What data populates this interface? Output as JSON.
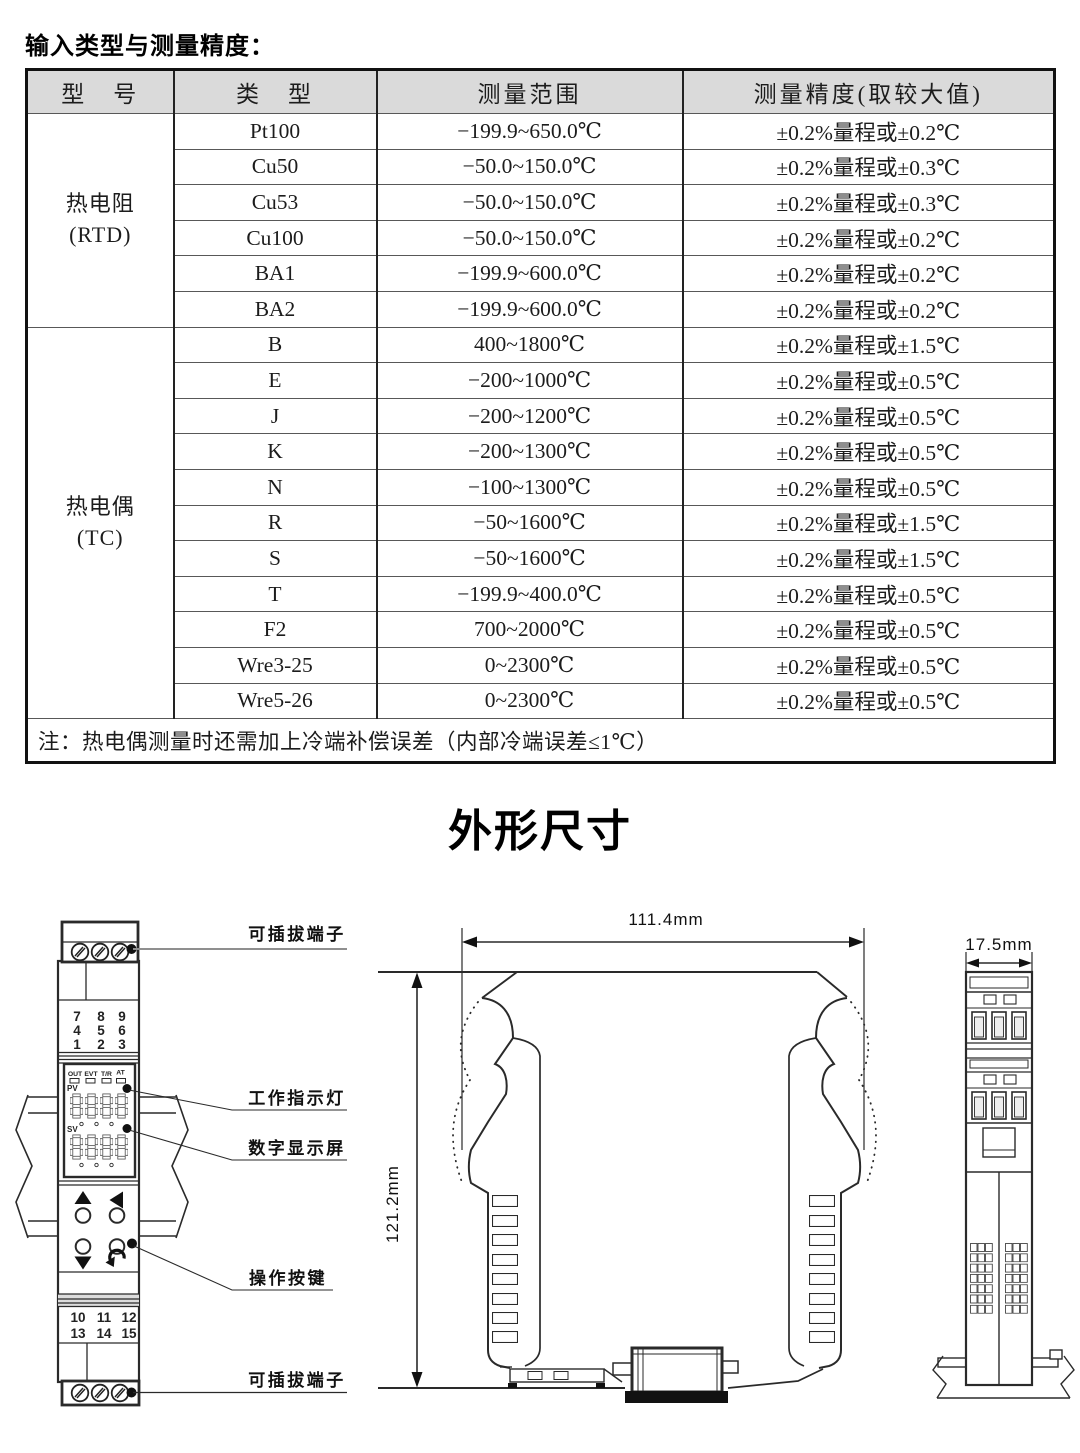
{
  "page": {
    "title": "输入类型与测量精度："
  },
  "table": {
    "headers": [
      "型　号",
      "类　型",
      "测量范围",
      "测量精度(取较大值)"
    ],
    "groups": [
      {
        "model": "热电阻",
        "model_sub": "(RTD)",
        "rows": [
          {
            "type": "Pt100",
            "range": "−199.9~650.0℃",
            "accuracy": "±0.2%量程或±0.2℃"
          },
          {
            "type": "Cu50",
            "range": "−50.0~150.0℃",
            "accuracy": "±0.2%量程或±0.3℃"
          },
          {
            "type": "Cu53",
            "range": "−50.0~150.0℃",
            "accuracy": "±0.2%量程或±0.3℃"
          },
          {
            "type": "Cu100",
            "range": "−50.0~150.0℃",
            "accuracy": "±0.2%量程或±0.2℃"
          },
          {
            "type": "BA1",
            "range": "−199.9~600.0℃",
            "accuracy": "±0.2%量程或±0.2℃"
          },
          {
            "type": "BA2",
            "range": "−199.9~600.0℃",
            "accuracy": "±0.2%量程或±0.2℃"
          }
        ]
      },
      {
        "model": "热电偶",
        "model_sub": "(TC)",
        "rows": [
          {
            "type": "B",
            "range": "400~1800℃",
            "accuracy": "±0.2%量程或±1.5℃"
          },
          {
            "type": "E",
            "range": "−200~1000℃",
            "accuracy": "±0.2%量程或±0.5℃"
          },
          {
            "type": "J",
            "range": "−200~1200℃",
            "accuracy": "±0.2%量程或±0.5℃"
          },
          {
            "type": "K",
            "range": "−200~1300℃",
            "accuracy": "±0.2%量程或±0.5℃"
          },
          {
            "type": "N",
            "range": "−100~1300℃",
            "accuracy": "±0.2%量程或±0.5℃"
          },
          {
            "type": "R",
            "range": "−50~1600℃",
            "accuracy": "±0.2%量程或±1.5℃"
          },
          {
            "type": "S",
            "range": "−50~1600℃",
            "accuracy": "±0.2%量程或±1.5℃"
          },
          {
            "type": "T",
            "range": "−199.9~400.0℃",
            "accuracy": "±0.2%量程或±0.5℃"
          },
          {
            "type": "F2",
            "range": "700~2000℃",
            "accuracy": "±0.2%量程或±0.5℃"
          },
          {
            "type": "Wre3-25",
            "range": "0~2300℃",
            "accuracy": "±0.2%量程或±0.5℃"
          },
          {
            "type": "Wre5-26",
            "range": "0~2300℃",
            "accuracy": "±0.2%量程或±0.5℃"
          }
        ]
      }
    ],
    "note": "注：热电偶测量时还需加上冷端补偿误差（内部冷端误差≤1℃）"
  },
  "outline": {
    "title": "外形尺寸",
    "callouts": {
      "terminal_top": "可插拔端子",
      "indicator": "工作指示灯",
      "display": "数字显示屏",
      "buttons": "操作按键",
      "terminal_bottom": "可插拔端子"
    },
    "front": {
      "keypad": [
        [
          "7",
          "8",
          "9"
        ],
        [
          "4",
          "5",
          "6"
        ],
        [
          "1",
          "2",
          "3"
        ]
      ],
      "status": [
        "OUT",
        "EVT",
        "T/R",
        "AT"
      ],
      "pv": "PV",
      "sv": "SV",
      "terminal_numbers": [
        [
          "10",
          "11",
          "12"
        ],
        [
          "13",
          "14",
          "15"
        ]
      ]
    },
    "dims": {
      "width": "111.4mm",
      "height": "121.2mm",
      "depth": "17.5mm"
    },
    "colors": {
      "led_red": "#e02b20",
      "table_header_bg": "#dadada"
    }
  }
}
